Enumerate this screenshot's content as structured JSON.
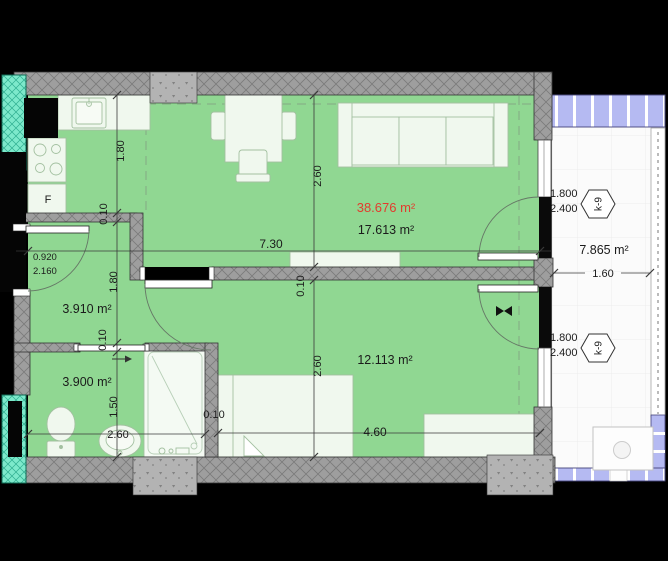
{
  "plan": {
    "rooms": {
      "total_area": "38.676 m²",
      "living_kitchen_area": "17.613 m²",
      "bedroom_area": "12.113 m²",
      "hallway_area": "3.910 m²",
      "bathroom_area": "3.900 m²",
      "balcony_area": "7.865 m²"
    },
    "appliances": {
      "fridge": "F"
    },
    "dims": {
      "kitchen_height": "1.80",
      "kitchen_wall_thk": "0.10",
      "hallway_height": "1.80",
      "bathroom_wall_thk": "0.10",
      "bathroom_height": "1.50",
      "bathroom_width": "2.60",
      "living_height": "2.60",
      "bedroom_height": "2.60",
      "overall_width": "7.30",
      "mid_wall_thk": "0.10",
      "shower_wall_thk": "0.10",
      "bedroom_width": "4.60",
      "balcony_width": "1.60"
    },
    "entry_door": {
      "width": "0.920",
      "height": "2.160"
    },
    "balcony_door": {
      "width": "1.800",
      "height": "2.400",
      "tag": "k-9"
    },
    "colors": {
      "floor_green": "#90d792",
      "wall_gray": "#9e9e9e",
      "glass_teal": "#7de9cb",
      "railing_blue": "#b5baf2",
      "highlight_red": "#e23b2e"
    }
  }
}
